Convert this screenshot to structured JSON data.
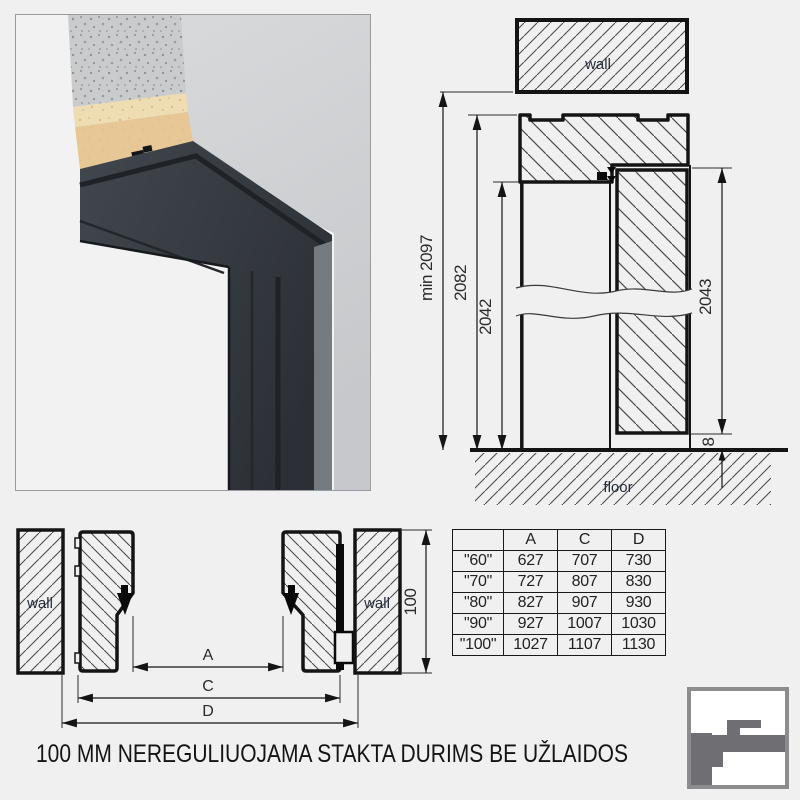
{
  "page": {
    "caption": "100 MM NEREGULIUOJAMA STAKTA DURIMS BE UŽLAIDOS",
    "background": "#f0f0f1"
  },
  "photo": {
    "alt": "3d-render-door-frame-corner"
  },
  "vertical_section": {
    "wall_label": "wall",
    "floor_label": "floor",
    "dims": {
      "min_total": "min 2097",
      "frame": "2082",
      "clear": "2042",
      "leaf": "2043",
      "gap": "8"
    }
  },
  "horizontal_section": {
    "left_wall_label": "wall",
    "right_wall_label": "wall",
    "dims": {
      "a": "A",
      "c": "C",
      "d": "D",
      "depth": "100"
    }
  },
  "size_table": {
    "headers": [
      "",
      "A",
      "C",
      "D"
    ],
    "rows": [
      [
        "\"60\"",
        "627",
        "707",
        "730"
      ],
      [
        "\"70\"",
        "727",
        "807",
        "830"
      ],
      [
        "\"80\"",
        "827",
        "907",
        "930"
      ],
      [
        "\"90\"",
        "927",
        "1007",
        "1030"
      ],
      [
        "\"100\"",
        "1027",
        "1107",
        "1130"
      ]
    ]
  },
  "colors": {
    "line": "#141414",
    "hatch": "#4d4d4d",
    "label_text": "#242c3a",
    "dim_text": "#2b2b2b",
    "frame_anthracite": "#343a41",
    "wood": "#e7c795",
    "concrete": "#c9cbcc",
    "wall_face": "#d2d4d6",
    "logo_gray": "#6e6e73",
    "logo_border": "#8c8c8e"
  }
}
